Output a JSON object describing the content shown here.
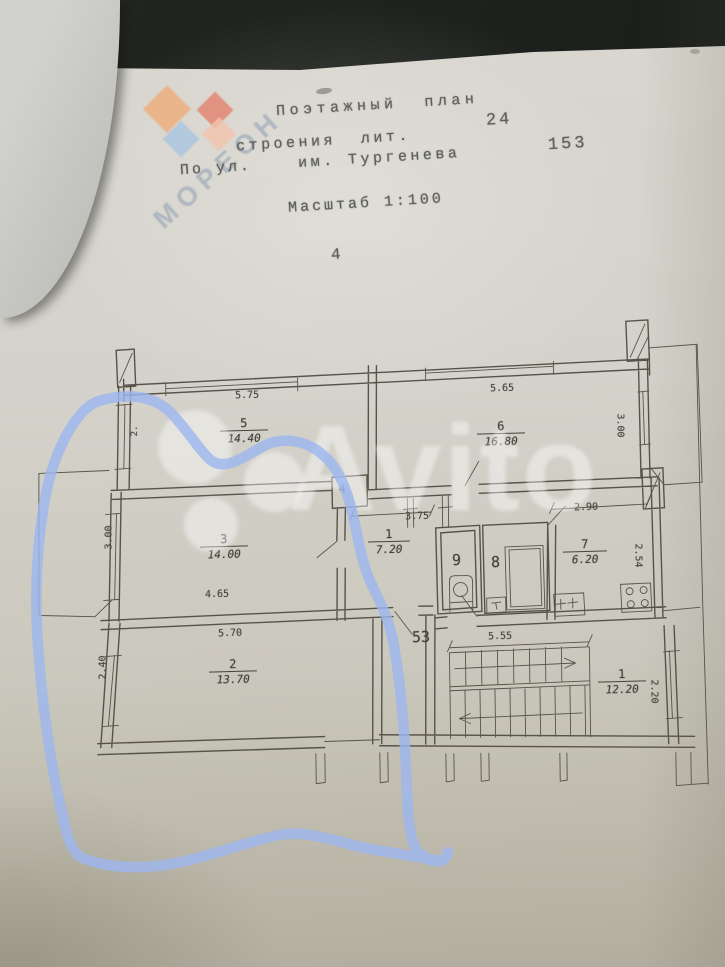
{
  "photo": {
    "background_color": "#20231f",
    "paper_color": "#d3d1c9",
    "pen_color": "#9db7f0",
    "ink_color": "#55514a"
  },
  "header": {
    "title": "Поэтажный  план",
    "line2_label": "строения  лит.",
    "line2_value": "24",
    "sheet_number": "153",
    "line3_prefix": "По ул.",
    "line3_street": "им. Тургенева",
    "scale_line": "Масштаб 1:100",
    "page_number": "4"
  },
  "watermarks": {
    "left_brand": "МОРЕОН",
    "center_brand": "Avito"
  },
  "plan": {
    "apartment_number": "53",
    "rooms": [
      {
        "num": "5",
        "area": "14.40"
      },
      {
        "num": "6",
        "area": "16.80"
      },
      {
        "num": "3",
        "area": "14.00"
      },
      {
        "num": "1",
        "area": "7.20"
      },
      {
        "num": "7",
        "area": "6.20"
      },
      {
        "num": "2",
        "area": "13.70"
      },
      {
        "num": "1",
        "area": "12.20"
      },
      {
        "num": "9"
      },
      {
        "num": "8"
      },
      {
        "num": "4"
      }
    ],
    "dimensions": {
      "room5_width": "5.75",
      "room5_left": "2.",
      "room6_width": "5.65",
      "room6_depth": "3.00",
      "hall_width": "3.75",
      "kitchen_width": "2.90",
      "kitchen_depth": "2.54",
      "room3_depth": "3.00",
      "room3_width": "4.65",
      "room2_width": "5.70",
      "room2_depth": "2.40",
      "stair_width": "5.55",
      "entry_depth": "2.20"
    }
  }
}
